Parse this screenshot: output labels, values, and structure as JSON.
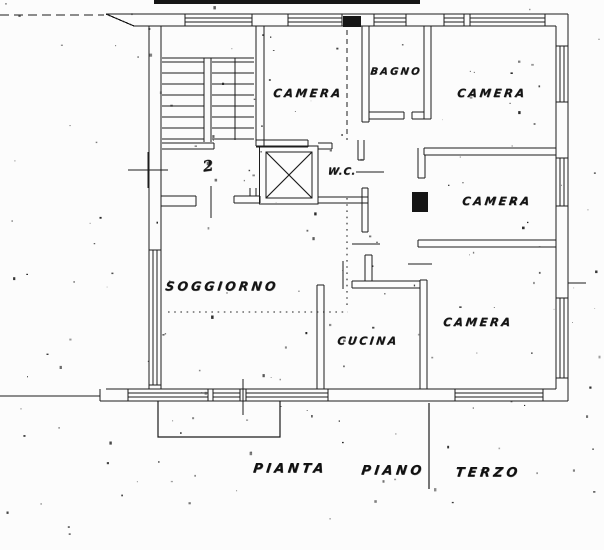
{
  "palette": {
    "ink": "#1c1c1c",
    "paper": "#fcfcfc"
  },
  "plan": {
    "apartment_number": "2",
    "rooms": {
      "camera_top_left": "CAMERA",
      "bagno": "BAGNO",
      "camera_top_right": "CAMERA",
      "camera_mid_right": "CAMERA",
      "wc": "W.C.",
      "soggiorno": "SOGGIORNO",
      "cucina": "CUCINA",
      "camera_bottom_right": "CAMERA"
    },
    "caption": {
      "word_1": "PIANTA",
      "word_2": "PIANO",
      "word_3": "TERZO"
    }
  }
}
